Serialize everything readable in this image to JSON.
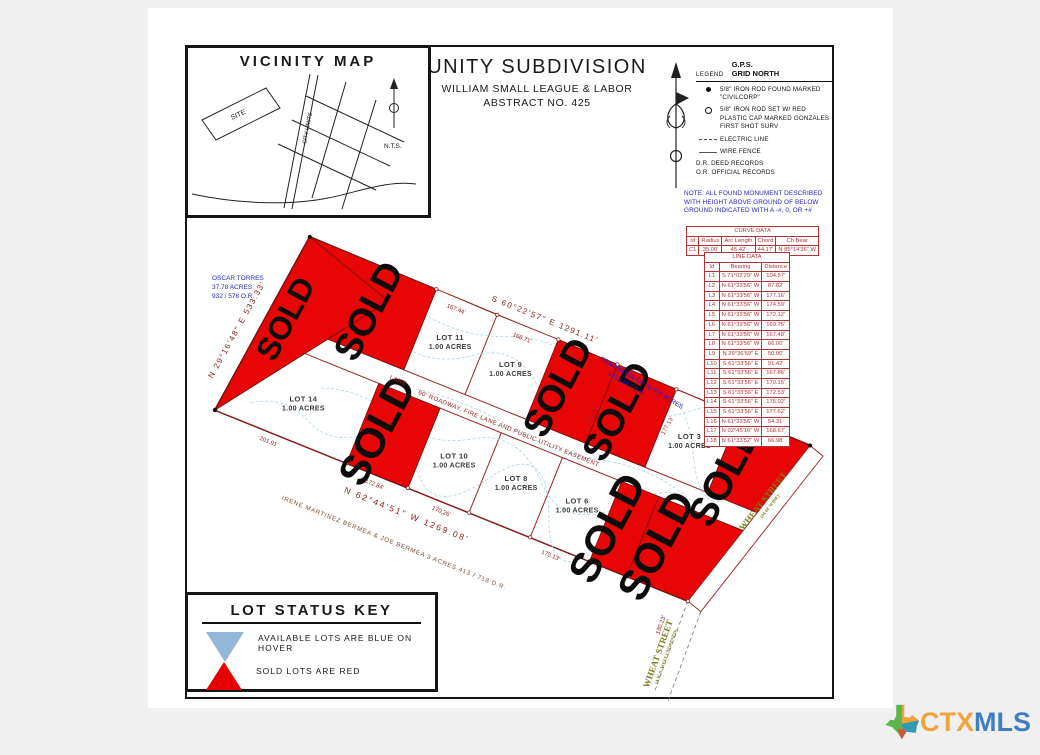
{
  "title_block": {
    "title": "UNITY SUBDIVISION",
    "subtitle1": "WILLIAM SMALL LEAGUE & LABOR",
    "subtitle2": "ABSTRACT NO. 425"
  },
  "vicinity": {
    "title": "VICINITY MAP",
    "site": "SITE",
    "city_limits": "CITY LIMITS",
    "nts": "N.T.S."
  },
  "legend": {
    "label": "LEGEND",
    "gps1": "G.P.S.",
    "gps2": "GRID NORTH",
    "items": [
      {
        "text": "5/8\" IRON ROD FOUND MARKED \"CIVILCORP\""
      },
      {
        "text": "5/8\" IRON ROD SET W/ RED PLASTIC CAP MARKED GONZALES FIRST SHOT SURV"
      },
      {
        "text": "ELECTRIC LINE"
      },
      {
        "text": "WIRE FENCE"
      }
    ],
    "abbr1": "D.R.   DEED RECORDS",
    "abbr2": "O.R.   OFFICIAL RECORDS"
  },
  "note": {
    "text": "NOTE: ALL FOUND MONUMENT DESCRIBED WITH HEIGHT ABOVE GROUND OF BELOW GROUND INDICATED WITH A -#, 0, OR +#"
  },
  "curve_table": {
    "title": "CURVE DATA",
    "headers": [
      "Id",
      "Radius",
      "Arc Length",
      "Chord",
      "Ch Bear"
    ],
    "rows": [
      {
        "id": "C1",
        "radius": "35.00'",
        "arc": "45.42'",
        "chord": "44.17'",
        "bear": "N 85°14'36\" W"
      }
    ]
  },
  "line_table": {
    "title": "LINE DATA",
    "headers": [
      "Id",
      "Bearing",
      "Distance"
    ],
    "rows": [
      {
        "id": "L1",
        "bearing": "S 71°02'29\" W",
        "distance": "104.57'"
      },
      {
        "id": "L2",
        "bearing": "N 61°33'56\" W",
        "distance": "87.82'"
      },
      {
        "id": "L3",
        "bearing": "N 61°33'56\" W",
        "distance": "177.16'"
      },
      {
        "id": "L4",
        "bearing": "N 61°33'56\" W",
        "distance": "174.59'"
      },
      {
        "id": "L5",
        "bearing": "N 61°33'56\" W",
        "distance": "172.12'"
      },
      {
        "id": "L6",
        "bearing": "N 61°33'56\" W",
        "distance": "169.75'"
      },
      {
        "id": "L7",
        "bearing": "N 61°33'56\" W",
        "distance": "167.48'"
      },
      {
        "id": "L8",
        "bearing": "N 61°33'56\" W",
        "distance": "66.00'"
      },
      {
        "id": "L9",
        "bearing": "N 29°36'59\" E",
        "distance": "50.00'"
      },
      {
        "id": "L10",
        "bearing": "S 61°33'56\" E",
        "distance": "91.42'"
      },
      {
        "id": "L11",
        "bearing": "S 61°33'56\" E",
        "distance": "167.86'"
      },
      {
        "id": "L12",
        "bearing": "S 61°33'56\" E",
        "distance": "170.15'"
      },
      {
        "id": "L13",
        "bearing": "S 61°33'56\" E",
        "distance": "172.53'"
      },
      {
        "id": "L14",
        "bearing": "S 61°33'56\" E",
        "distance": "175.02'"
      },
      {
        "id": "L15",
        "bearing": "S 61°33'56\" E",
        "distance": "177.62'"
      },
      {
        "id": "L16",
        "bearing": "N 61°33'56\" W",
        "distance": "54.31'"
      },
      {
        "id": "L17",
        "bearing": "N 02°45'16\" W",
        "distance": "168.67'"
      },
      {
        "id": "L18",
        "bearing": "N 61°33'52\" W",
        "distance": "66.98'"
      }
    ]
  },
  "plat": {
    "sold_label": "SOLD",
    "sold_color": "#e80505",
    "lots": [
      {
        "name": "LOT 11",
        "acres": "1.00 ACRES"
      },
      {
        "name": "LOT 9",
        "acres": "1.00 ACRES"
      },
      {
        "name": "LOT 3",
        "acres": "1.00 ACRES"
      },
      {
        "name": "LOT 14",
        "acres": "1.00 ACRES"
      },
      {
        "name": "LOT 10",
        "acres": "1.00 ACRES"
      },
      {
        "name": "LOT 8",
        "acres": "1.00 ACRES"
      },
      {
        "name": "LOT 6",
        "acres": "1.00 ACRES"
      }
    ],
    "bearings": {
      "left": "N 29°16'48\" E   533.33'",
      "top": "S 60°22'57\" E   1291.11'",
      "bottom": "N 62°44'51\" W   1269.08'"
    },
    "dims": [
      "167.44'",
      "166.71'",
      "247.75'",
      "177.13'",
      "121.49'",
      "201.91'",
      "172.84'",
      "170.26'",
      "175.13'",
      "130.23'"
    ],
    "road": {
      "name": "LANE",
      "easement": "60' ROADWAY, FIRE LANE AND PUBLIC UTILITY EASEMENT"
    },
    "streets": {
      "wheat_upper": "WHEAT STREET",
      "wheat_upper_note": "(44.44' WIDE)",
      "wheat_lower": "WHEAT STREET",
      "wheat_lower_note": "(A.K.A. WEST UNOPENED)"
    },
    "adjoiners": {
      "west_1": "OSCAR TORRES",
      "west_2": "37.78 ACRES",
      "west_3": "932 / 578 O.R.",
      "south": "IRENE MARTINEZ BERMEA  &  JOE BERMEA      3  ACRES      413 / 718  D.R.",
      "east_1": "REMAINDER OF 76.816 ACRES",
      "east_2": "975 / 687 O.R."
    }
  },
  "status_key": {
    "title": "LOT STATUS KEY",
    "available_label": "AVAILABLE LOTS ARE BLUE ON HOVER",
    "sold_label": "SOLD LOTS ARE RED",
    "available_color": "#92b7d8",
    "sold_color": "#e60000"
  },
  "logo": {
    "ctx": "CTX",
    "mls": "MLS",
    "ctx_color": "#f2a33c",
    "mls_color": "#3f7fbf"
  }
}
